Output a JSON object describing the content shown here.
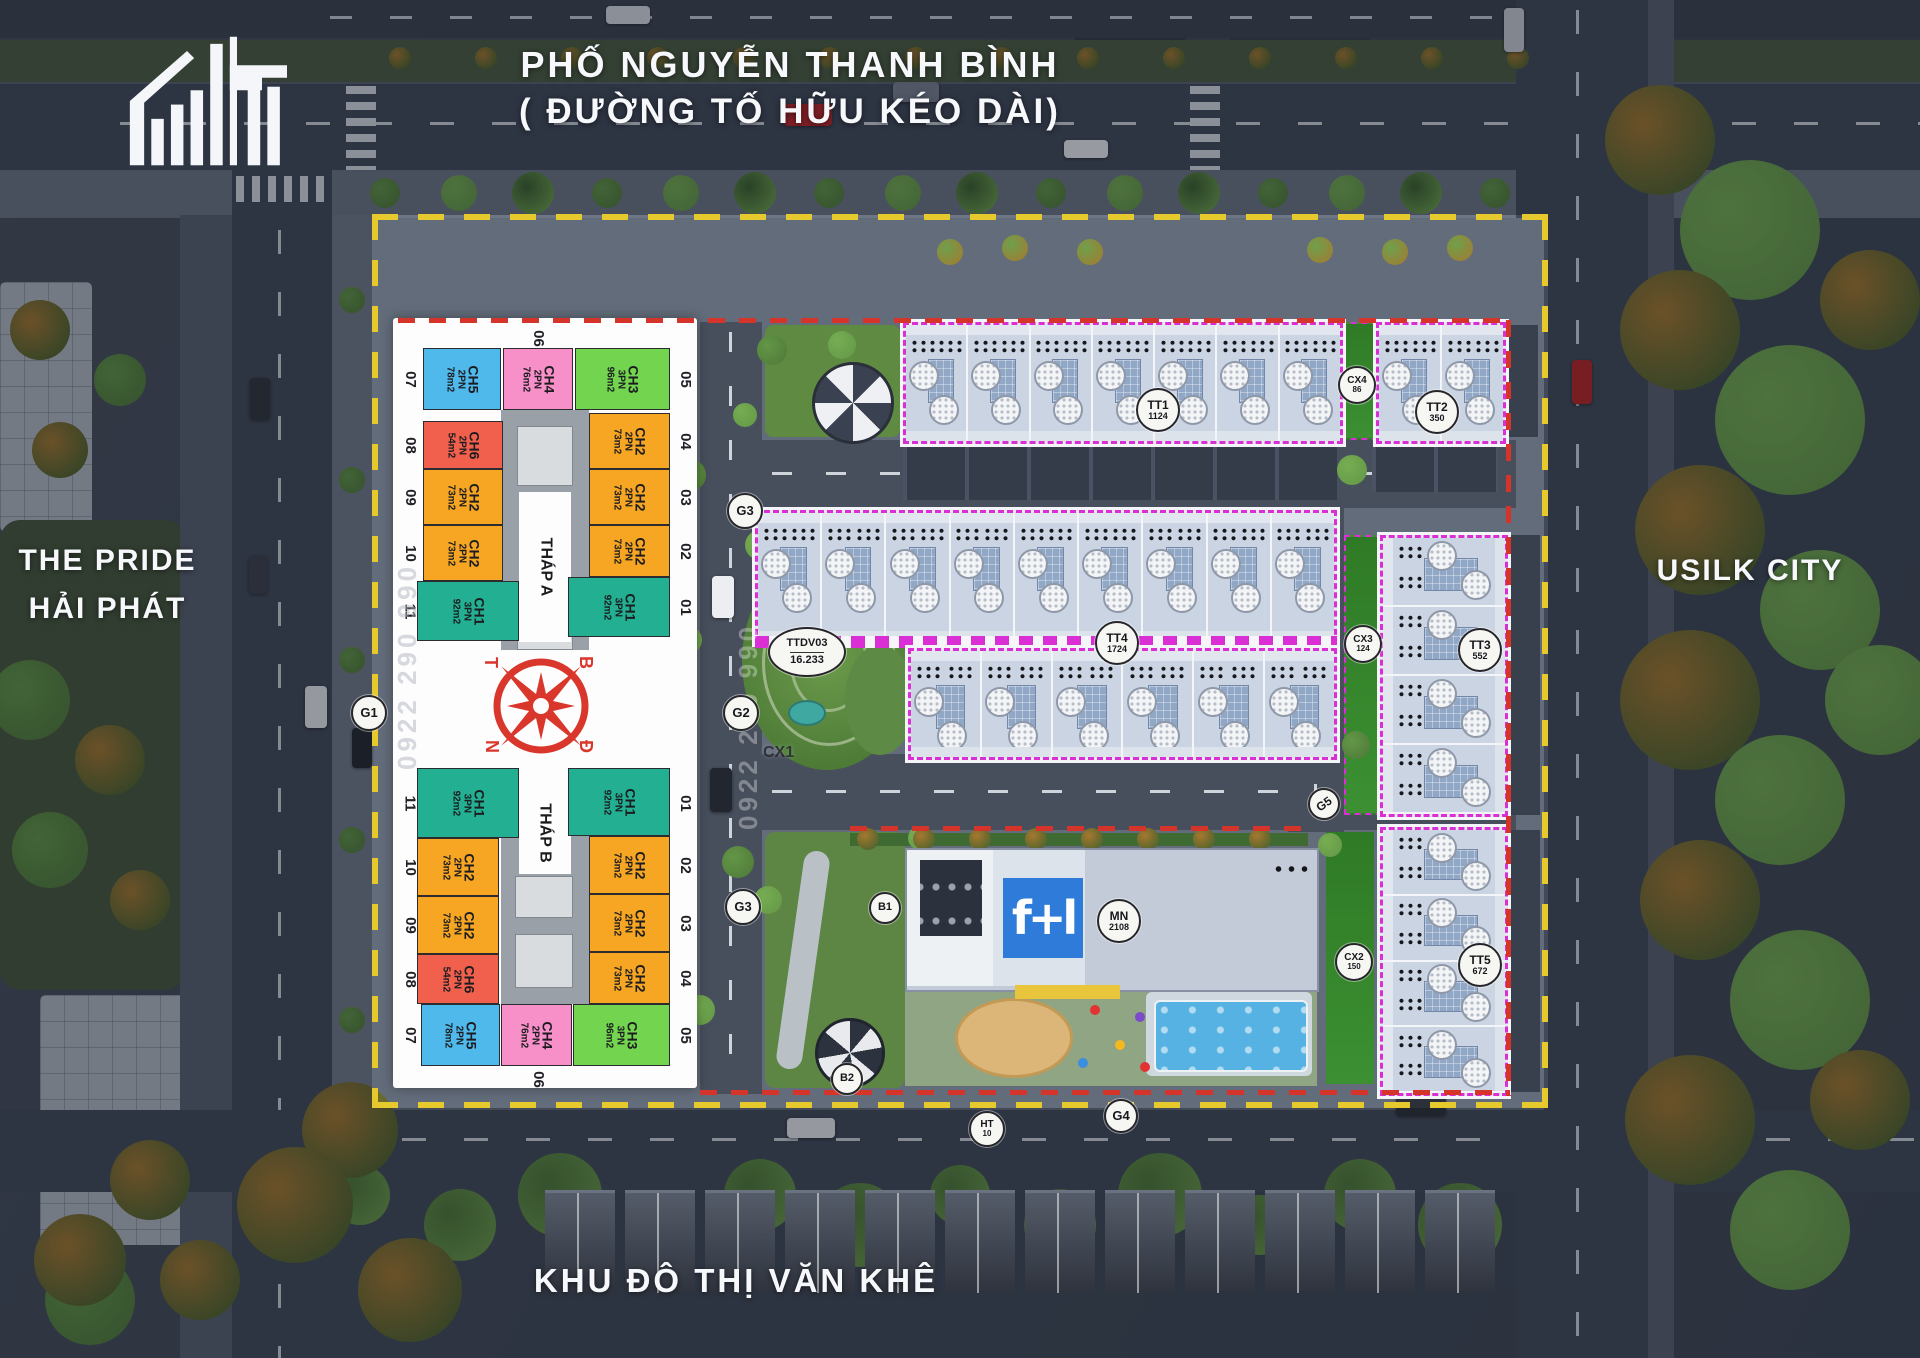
{
  "header": {
    "line1": "PHỐ NGUYỄN THANH BÌNH",
    "line2": "( ĐƯỜNG TỐ HỮU KÉO DÀI)"
  },
  "landmarks": {
    "west1": "THE PRIDE",
    "west2": "HẢI PHÁT",
    "east": "USILK CITY",
    "south": "KHU ĐÔ THỊ VĂN KHÊ"
  },
  "compass": {
    "tl": "T",
    "tr": "B",
    "bl": "N",
    "br": "Đ"
  },
  "watermark": "0922 290 990",
  "unit_types": {
    "CH1": {
      "bedrooms": "3PN",
      "area": "92m2",
      "color": "#23af91"
    },
    "CH2": {
      "bedrooms": "2PN",
      "area": "73m2",
      "color": "#f6a623"
    },
    "CH3": {
      "bedrooms": "3PN",
      "area": "96m2",
      "color": "#72d44f"
    },
    "CH4": {
      "bedrooms": "2PN",
      "area": "76m2",
      "color": "#f78fc9"
    },
    "CH5": {
      "bedrooms": "2PN",
      "area": "78m2",
      "color": "#4fb9ec"
    },
    "CH6": {
      "bedrooms": "2PN",
      "area": "54m2",
      "color": "#f1604d"
    }
  },
  "towers": [
    {
      "name": "THÁP A",
      "units": [
        {
          "pos": "07",
          "type": "CH5"
        },
        {
          "pos": "06",
          "type": "CH4"
        },
        {
          "pos": "05",
          "type": "CH3"
        },
        {
          "pos": "08",
          "type": "CH6"
        },
        {
          "pos": "09",
          "type": "CH2"
        },
        {
          "pos": "10",
          "type": "CH2"
        },
        {
          "pos": "11",
          "type": "CH1"
        },
        {
          "pos": "04",
          "type": "CH2"
        },
        {
          "pos": "03",
          "type": "CH2"
        },
        {
          "pos": "02",
          "type": "CH2"
        },
        {
          "pos": "01",
          "type": "CH1"
        }
      ]
    },
    {
      "name": "THÁP B",
      "units": [
        {
          "pos": "11",
          "type": "CH1"
        },
        {
          "pos": "10",
          "type": "CH2"
        },
        {
          "pos": "09",
          "type": "CH2"
        },
        {
          "pos": "08",
          "type": "CH6"
        },
        {
          "pos": "07",
          "type": "CH5"
        },
        {
          "pos": "01",
          "type": "CH1"
        },
        {
          "pos": "02",
          "type": "CH2"
        },
        {
          "pos": "03",
          "type": "CH2"
        },
        {
          "pos": "04",
          "type": "CH2"
        },
        {
          "pos": "05",
          "type": "CH3"
        },
        {
          "pos": "06",
          "type": "CH4"
        }
      ]
    }
  ],
  "parcels": [
    {
      "id": "TT1",
      "value": "1124"
    },
    {
      "id": "TT2",
      "value": "350"
    },
    {
      "id": "TT3",
      "value": "552"
    },
    {
      "id": "TT4",
      "value": "1724"
    },
    {
      "id": "TT5",
      "value": "672"
    },
    {
      "id": "CX2",
      "value": "150"
    },
    {
      "id": "CX3",
      "value": "124"
    },
    {
      "id": "CX4",
      "value": "86"
    },
    {
      "id": "MN",
      "value": "2108"
    },
    {
      "id": "TTDV03",
      "value": "16.233"
    },
    {
      "id": "HT",
      "value": "10"
    }
  ],
  "road_labels": [
    "G1",
    "G2",
    "G3",
    "G3",
    "G4",
    "G5",
    "B1",
    "B2",
    "CX1"
  ]
}
